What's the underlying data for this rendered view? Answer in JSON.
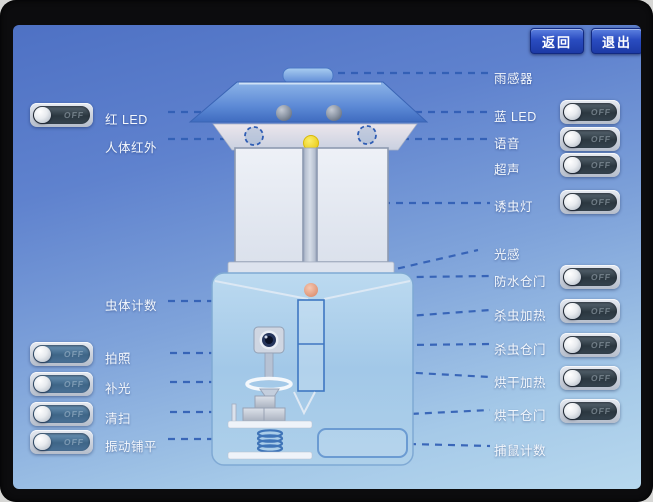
{
  "screen": {
    "buttons": [
      {
        "label": "返回"
      },
      {
        "label": "退出"
      }
    ]
  },
  "left_column": {
    "items": [
      {
        "label": "红 LED",
        "has_toggle": true,
        "state": "OFF",
        "track": "dark"
      },
      {
        "label": "人体红外",
        "has_toggle": false
      },
      {
        "label": "虫体计数",
        "has_toggle": false
      },
      {
        "label": "拍照",
        "has_toggle": true,
        "state": "OFF",
        "track": "blue"
      },
      {
        "label": "补光",
        "has_toggle": true,
        "state": "OFF",
        "track": "blue"
      },
      {
        "label": "清扫",
        "has_toggle": true,
        "state": "OFF",
        "track": "blue"
      },
      {
        "label": "振动铺平",
        "has_toggle": true,
        "state": "OFF",
        "track": "blue"
      }
    ]
  },
  "right_column": {
    "items": [
      {
        "label": "雨感器",
        "has_toggle": false
      },
      {
        "label": "蓝 LED",
        "has_toggle": true,
        "state": "OFF",
        "track": "dark"
      },
      {
        "label": "语音",
        "has_toggle": true,
        "state": "OFF",
        "track": "dark"
      },
      {
        "label": "超声",
        "has_toggle": true,
        "state": "OFF",
        "track": "dark"
      },
      {
        "label": "诱虫灯",
        "has_toggle": true,
        "state": "OFF",
        "track": "dark"
      },
      {
        "label": "光感",
        "has_toggle": false
      },
      {
        "label": "防水仓门",
        "has_toggle": true,
        "state": "OFF",
        "track": "dark"
      },
      {
        "label": "杀虫加热",
        "has_toggle": true,
        "state": "OFF",
        "track": "dark"
      },
      {
        "label": "杀虫仓门",
        "has_toggle": true,
        "state": "OFF",
        "track": "dark"
      },
      {
        "label": "烘干加热",
        "has_toggle": true,
        "state": "OFF",
        "track": "dark"
      },
      {
        "label": "烘干仓门",
        "has_toggle": true,
        "state": "OFF",
        "track": "dark"
      },
      {
        "label": "捕鼠计数",
        "has_toggle": false
      }
    ]
  },
  "palette": {
    "screen_top": "#4e71c4",
    "screen_bottom": "#b7d8ee",
    "button_blue": "#2a4cc0",
    "dash_line": "#2f5db4",
    "toggle_track_dark": "#2b3740",
    "toggle_track_blue": "#3e6587",
    "lure_lamp_yellow": "#f2d818",
    "counter_ball_orange": "#e49a7e"
  },
  "diagram": {
    "components": [
      "rain-sensor-cap",
      "roof",
      "red-led-sphere",
      "blue-led-sphere",
      "pir-sensor-circle",
      "voice-sensor-circle",
      "lure-lamp",
      "left-glass-panel",
      "right-glass-panel",
      "lamp-tube",
      "panel-base",
      "device-body",
      "insect-funnel",
      "insect-counter-ball",
      "kill-dry-compartment",
      "funnel-tip",
      "camera",
      "camera-stand",
      "fill-light-ring",
      "light-cone",
      "cleaning-stick",
      "cleaning-brush-blocks",
      "tray-platform-upper",
      "vibration-spring",
      "tray-platform-lower",
      "mouse-drawer"
    ]
  }
}
